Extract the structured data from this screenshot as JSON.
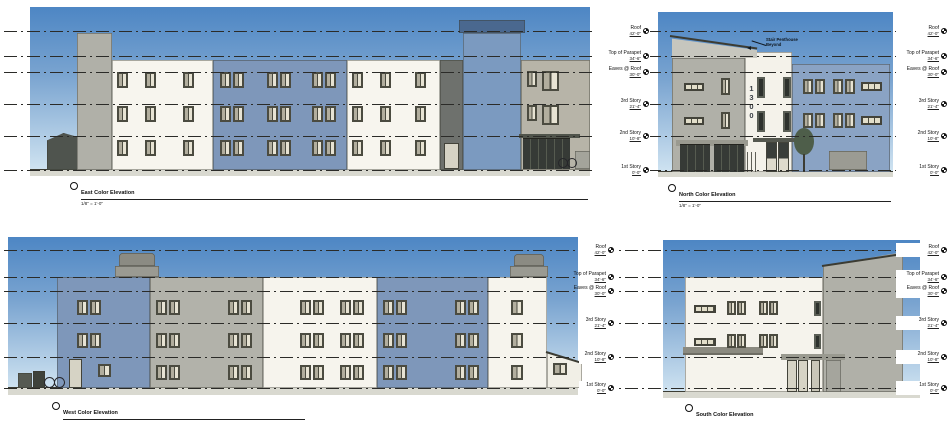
{
  "sheet": {
    "type": "architectural color elevations",
    "palette": {
      "sky_top": "#4d86c4",
      "sky_bottom": "#cfe3f1",
      "facade_blue": "#7e97ba",
      "facade_blue_light": "#8aa3c4",
      "facade_white": "#f6f4ed",
      "facade_gray": "#b2b2aa",
      "accent_dark": "#3a3e3a",
      "ground": "#d9d9d0"
    }
  },
  "levels": {
    "labels": [
      {
        "name": "Roof",
        "elevation": "42'-0\""
      },
      {
        "name": "Top of Parapet",
        "elevation": "34'-6\""
      },
      {
        "name": "Eaves @ Roof",
        "elevation": "30'-0\""
      },
      {
        "name": "3rd Story",
        "elevation": "21'-4\""
      },
      {
        "name": "2nd Story",
        "elevation": "10'-8\""
      },
      {
        "name": "1st Story",
        "elevation": "0'-0\""
      }
    ]
  },
  "elevations": [
    {
      "title": "East Color Elevation",
      "scale": "1/8\" = 1'-0\""
    },
    {
      "title": "North Color Elevation",
      "scale": "1/8\" = 1'-0\""
    },
    {
      "title": "West Color Elevation",
      "scale": "1/8\" = 1'-0\""
    },
    {
      "title": "South Color Elevation",
      "scale": "1/8\" = 1'-0\""
    }
  ],
  "annotations": {
    "penthouse_note_line1": "Stair Penthouse",
    "penthouse_note_line2": "Beyond",
    "address_sign": "1300"
  }
}
